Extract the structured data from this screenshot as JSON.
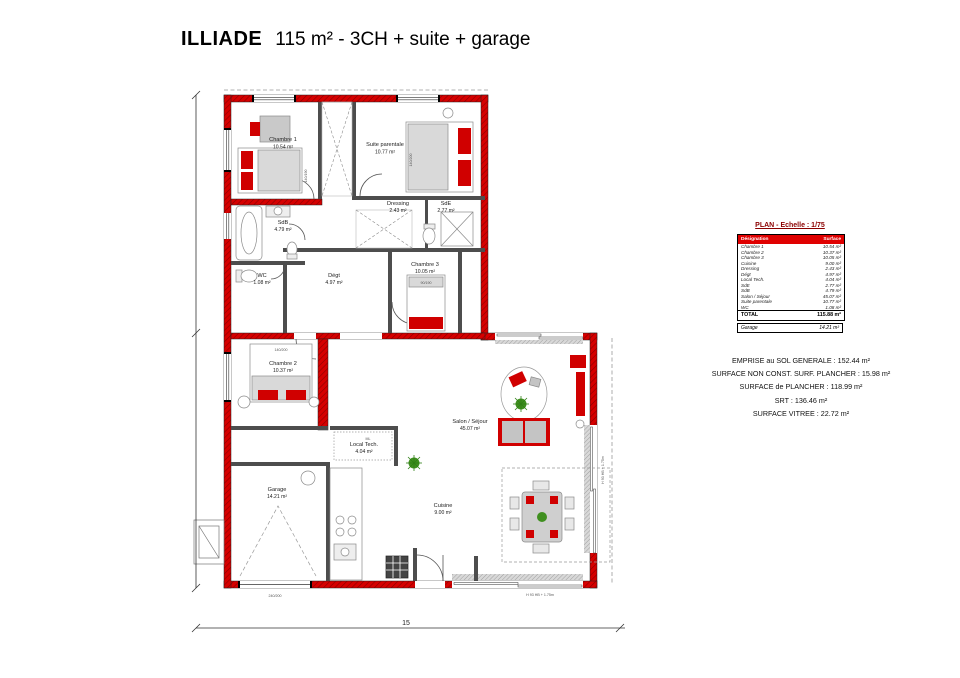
{
  "title": {
    "name": "ILLIADE",
    "subtitle": "115 m² - 3CH + suite + garage"
  },
  "plan": {
    "scale_title": "PLAN - Echelle : 1/75",
    "labels": {
      "chambre1": {
        "name": "Chambre 1",
        "area": "10.54 m²"
      },
      "chambre2": {
        "name": "Chambre 2",
        "area": "10.37 m²"
      },
      "chambre3": {
        "name": "Chambre 3",
        "area": "10.05 m²"
      },
      "suite": {
        "name": "Suite parentale",
        "area": "10.77 m²"
      },
      "sdb": {
        "name": "SdB",
        "area": "4.79 m²"
      },
      "sde": {
        "name": "SdE",
        "area": "2.77 m²"
      },
      "wc": {
        "name": "WC",
        "area": "1.08 m²"
      },
      "degt": {
        "name": "Dégt",
        "area": "4.97 m²"
      },
      "dressing": {
        "name": "Dressing",
        "area": "2.43 m²"
      },
      "localtech": {
        "name": "Local Tech.",
        "area": "4.04 m²"
      },
      "salon": {
        "name": "Salon / Séjour",
        "area": "45.07 m²"
      },
      "cuisine": {
        "name": "Cuisine",
        "area": "9.00 m²"
      },
      "garage": {
        "name": "Garage",
        "area": "14.21 m²"
      }
    },
    "beds": {
      "c1": "140/190",
      "suite": "140/200",
      "c2": "140/200",
      "c3": "90/190"
    },
    "annotations": {
      "ml": "ML",
      "win_bottom": "H 93 HB + 1.75m",
      "win_right": "H 93 HB + 1.75m",
      "garage_door": "240/200"
    },
    "dimensions": {
      "width": "15"
    }
  },
  "table": {
    "headers": [
      "Désignation",
      "Surface"
    ],
    "rows": [
      [
        "Chambre 1",
        "10.54 m²"
      ],
      [
        "Chambre 2",
        "10.37 m²"
      ],
      [
        "Chambre 3",
        "10.05 m²"
      ],
      [
        "Cuisine",
        "9.00 m²"
      ],
      [
        "Dressing",
        "2.43 m²"
      ],
      [
        "Dégt",
        "4.97 m²"
      ],
      [
        "Local Tech.",
        "4.04 m²"
      ],
      [
        "SdE",
        "2.77 m²"
      ],
      [
        "SdB",
        "4.79 m²"
      ],
      [
        "Salon / Séjour",
        "45.07 m²"
      ],
      [
        "Suite parentale",
        "10.77 m²"
      ],
      [
        "WC",
        "1.08 m²"
      ]
    ],
    "total": {
      "label": "TOTAL",
      "value": "115.88 m²"
    },
    "garage": {
      "label": "Garage",
      "value": "14.21 m²"
    }
  },
  "summary": [
    "EMPRISE au SOL GENERALE : 152.44 m²",
    "SURFACE NON CONST. SURF. PLANCHER : 15.98 m²",
    "SURFACE de PLANCHER : 118.99 m²",
    "SRT : 136.46 m²",
    "SURFACE VITREE : 22.72 m²"
  ],
  "colors": {
    "wall_red": "#d60000",
    "accent_red": "#e00000",
    "plant_green": "#3f8f1f"
  }
}
